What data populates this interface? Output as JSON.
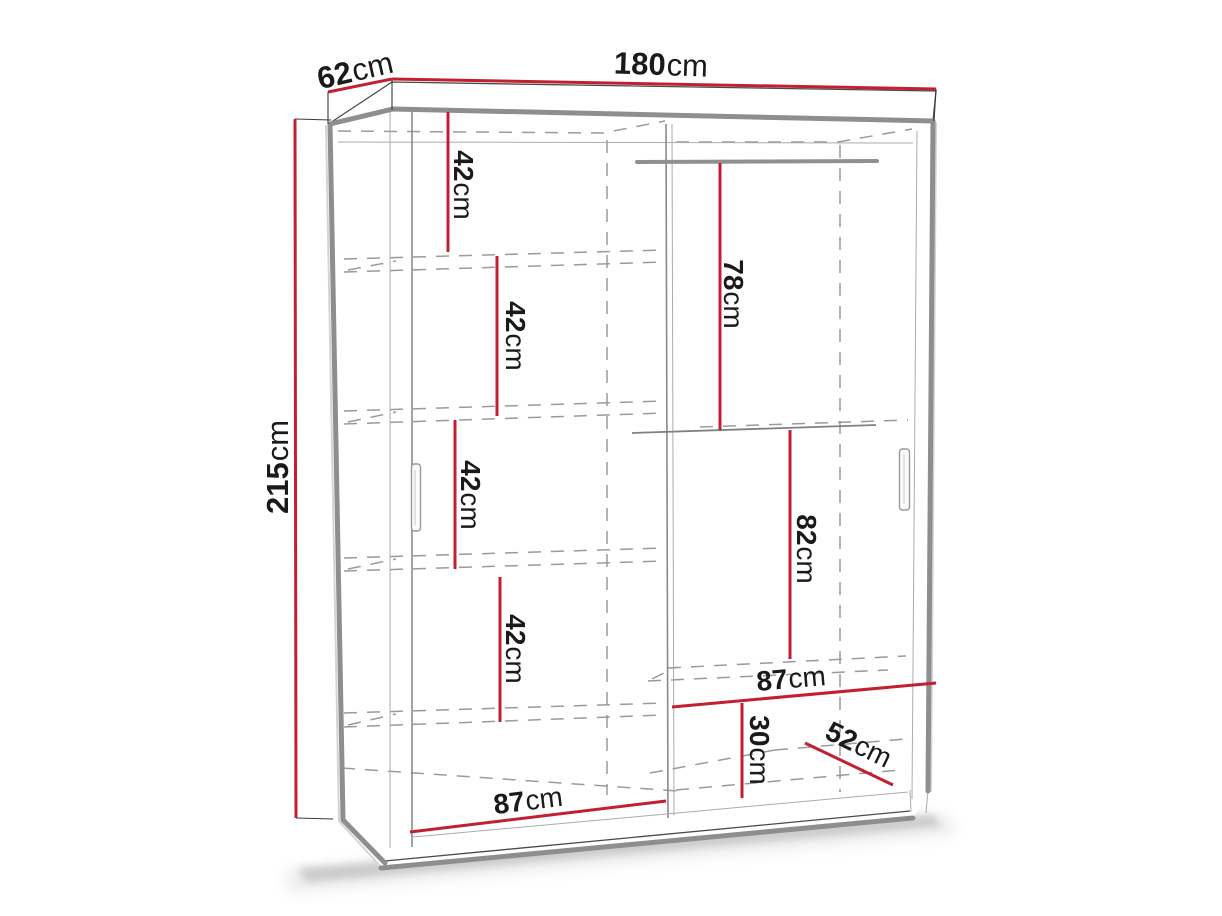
{
  "diagram": {
    "subject": "wardrobe-dimension-diagram",
    "colors": {
      "dimension_line": "#c22030",
      "outline_gray": "#8e8e8e",
      "detail_line": "#4a4a4a",
      "dashed_line": "#9a9a9a",
      "label_text": "#1a1a1a",
      "background": "#ffffff"
    },
    "labels": {
      "width": {
        "value": "180",
        "unit": "cm"
      },
      "depth": {
        "value": "62",
        "unit": "cm"
      },
      "height": {
        "value": "215",
        "unit": "cm"
      },
      "shelf_gap_1": {
        "value": "42",
        "unit": "cm"
      },
      "shelf_gap_2": {
        "value": "42",
        "unit": "cm"
      },
      "shelf_gap_3": {
        "value": "42",
        "unit": "cm"
      },
      "shelf_gap_4": {
        "value": "42",
        "unit": "cm"
      },
      "hanging_upper": {
        "value": "78",
        "unit": "cm"
      },
      "hanging_lower": {
        "value": "82",
        "unit": "cm"
      },
      "right_section_width": {
        "value": "87",
        "unit": "cm"
      },
      "bottom_shelf_gap": {
        "value": "30",
        "unit": "cm"
      },
      "interior_depth": {
        "value": "52",
        "unit": "cm"
      },
      "left_section_width": {
        "value": "87",
        "unit": "cm"
      }
    }
  }
}
